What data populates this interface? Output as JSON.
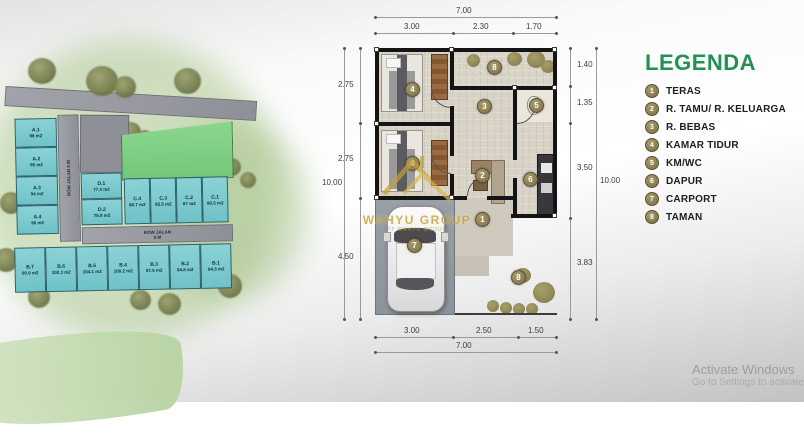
{
  "colors": {
    "legend_green": "#219253",
    "marker_olive": "#8A7C52",
    "plot_teal": "#7FC9CE",
    "estate_green": "#7FD083",
    "road_gray": "#9B9BA3",
    "garden_green": "#5EAD35",
    "carport_gray": "#959BA3",
    "wall_black": "#141414",
    "watermark_gold": "#C5A132"
  },
  "site_plan": {
    "road_vertical": {
      "line1": "ROW JALAN",
      "line2": "6 M"
    },
    "road_horizontal": {
      "line1": "ROW JALAN",
      "line2": "6 M"
    },
    "plots_a": [
      {
        "name": "A.1",
        "area": "98 m2"
      },
      {
        "name": "A.2",
        "area": "95 m2"
      },
      {
        "name": "A.3",
        "area": "94 m2"
      },
      {
        "name": "A.4",
        "area": "90 m2"
      }
    ],
    "plots_d": [
      {
        "name": "D.1",
        "area": "77.3 m2"
      },
      {
        "name": "D.2",
        "area": "75.9 m2"
      }
    ],
    "plots_c": [
      {
        "name": "C.4",
        "area": "86.7 m2"
      },
      {
        "name": "C.3",
        "area": "85.5 m2"
      },
      {
        "name": "C.2",
        "area": "87 m2"
      },
      {
        "name": "C.1",
        "area": "88.5 m2"
      }
    ],
    "plots_b": [
      {
        "name": "B.7",
        "area": "90.9 m2"
      },
      {
        "name": "B.6",
        "area": "102.3 m2"
      },
      {
        "name": "B.5",
        "area": "104.1 m2"
      },
      {
        "name": "B.4",
        "area": "100.2 m2"
      },
      {
        "name": "B.3",
        "area": "87.6 m2"
      },
      {
        "name": "B.2",
        "area": "94.8 m2"
      },
      {
        "name": "B.1",
        "area": "94.3 m2"
      }
    ]
  },
  "floor_plan": {
    "dim_top_total": "7.00",
    "dim_top_segments": [
      "3.00",
      "2.30",
      "1.70"
    ],
    "dim_bottom_segments": [
      "3.00",
      "2.50",
      "1.50"
    ],
    "dim_bottom_total": "7.00",
    "dim_left_segments": [
      "2.75",
      "2.75",
      "4.50"
    ],
    "dim_left_total": "10.00",
    "dim_right_segments": [
      "1.40",
      "1.35",
      "3.50",
      "3.83"
    ],
    "dim_right_total": "10.00",
    "markers": {
      "teras": "1",
      "tamu": "2",
      "bebas": "3",
      "tidur_atas": "4",
      "tidur_bawah": "4",
      "kmwc": "5",
      "dapur": "6",
      "carport": "7",
      "taman_atas": "8",
      "taman_bawah": "8"
    }
  },
  "legend": {
    "title": "LEGENDA",
    "items": [
      {
        "num": "1",
        "label": "TERAS"
      },
      {
        "num": "2",
        "label": "R. TAMU/ R. KELUARGA"
      },
      {
        "num": "3",
        "label": "R. BEBAS"
      },
      {
        "num": "4",
        "label": "KAMAR TIDUR"
      },
      {
        "num": "5",
        "label": "KM/WC"
      },
      {
        "num": "6",
        "label": "DAPUR"
      },
      {
        "num": "7",
        "label": "CARPORT"
      },
      {
        "num": "8",
        "label": "TAMAN"
      }
    ]
  },
  "watermark": {
    "name": "WAHYU GROUP",
    "subtitle": "PT WAHYU GROUP"
  },
  "windows_watermark": {
    "line1": "Activate Windows",
    "line2": "Go to Settings to activate"
  }
}
